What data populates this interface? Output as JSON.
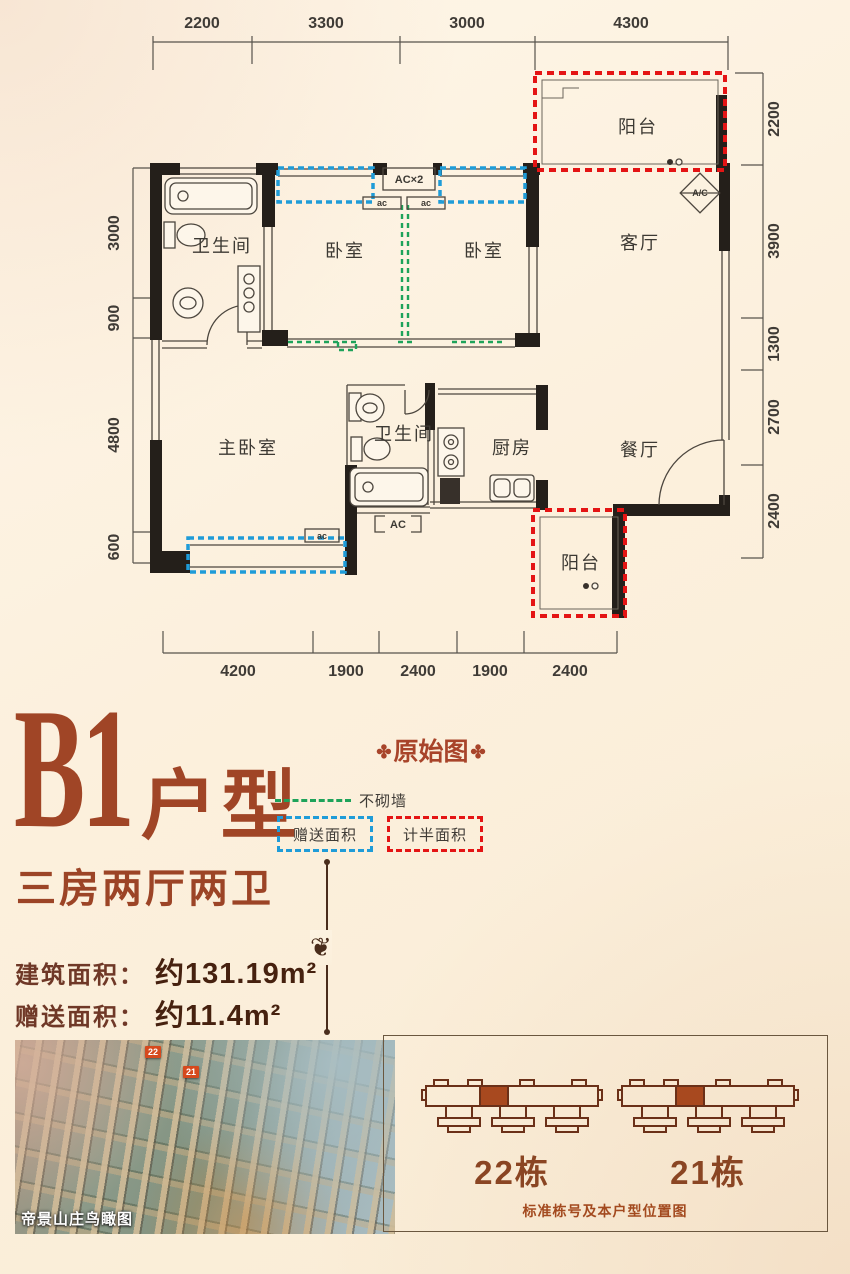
{
  "plan": {
    "dims": {
      "top": [
        "2200",
        "3300",
        "3000",
        "4300"
      ],
      "bottom": [
        "4200",
        "1900",
        "2400",
        "1900",
        "2400"
      ],
      "left": [
        "3000",
        "900",
        "4800",
        "600"
      ],
      "right": [
        "2200",
        "3900",
        "1300",
        "2700",
        "2400"
      ]
    },
    "rooms": {
      "bath1": "卫生间",
      "bedroom1": "卧室",
      "bedroom2": "卧室",
      "living": "客厅",
      "balcony_top": "阳台",
      "master": "主卧室",
      "bath2": "卫生间",
      "kitchen": "厨房",
      "dining": "餐厅",
      "balcony_bottom": "阳台"
    },
    "annotations": {
      "ac2": "AC×2",
      "ac_small": "ac",
      "ac_box": "AC",
      "ac_diamond": "A/C"
    }
  },
  "info": {
    "code": "B1",
    "suffix": "户型",
    "subtitle": "三房两厅两卫",
    "areas": [
      {
        "label": "建筑面积：",
        "value": "约131.19m²"
      },
      {
        "label": "赠送面积：",
        "value": "约11.4m²"
      }
    ]
  },
  "legend": {
    "title": "原始图",
    "ornament": "✤",
    "no_wall": "不砌墙",
    "gift_area": "赠送面积",
    "half_area": "计半面积",
    "divider_ornament": "❦"
  },
  "photo": {
    "caption": "帝景山庄鸟瞰图",
    "markers": [
      "22",
      "21"
    ]
  },
  "location_panel": {
    "buildings": [
      {
        "label": "22栋"
      },
      {
        "label": "21栋"
      }
    ],
    "caption": "标准栋号及本户型位置图"
  },
  "colors": {
    "accent_brown": "#a04526",
    "wall": "#241f1a",
    "gift_blue": "#1f9cd8",
    "half_red": "#e41414",
    "nowall_green": "#1ea35a",
    "highlight_unit": "#a8491f"
  }
}
